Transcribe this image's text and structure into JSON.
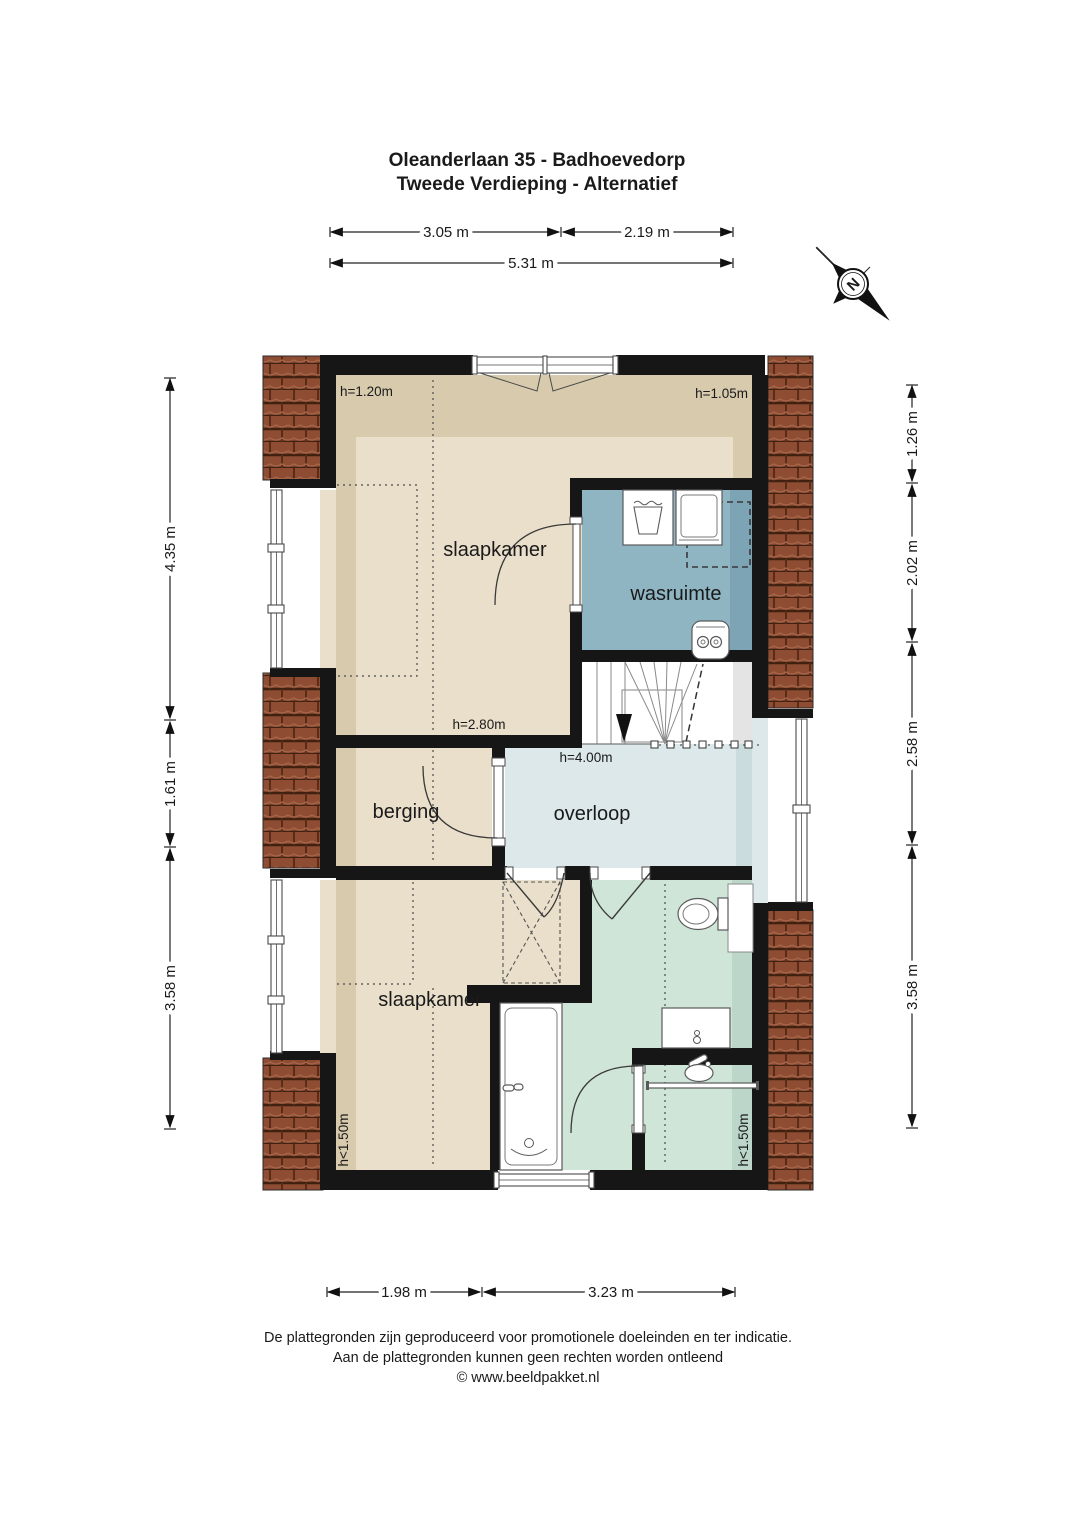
{
  "title": {
    "line1": "Oleanderlaan 35 - Badhoevedorp",
    "line2": "Tweede Verdieping - Alternatief"
  },
  "compass": {
    "label": "N"
  },
  "rooms": {
    "bedroom_top": "slaapkamer",
    "laundry": "wasruimte",
    "storage": "berging",
    "landing": "overloop",
    "bedroom_bottom": "slaapkamer"
  },
  "heights": {
    "bedroom_top_left": "h=1.20m",
    "bedroom_top_right": "h=1.05m",
    "storage": "h=2.80m",
    "landing": "h=4.00m",
    "bedroom_bottom_left": "h<1.50m",
    "bathroom_right": "h<1.50m"
  },
  "dimensions": {
    "top": [
      "3.05 m",
      "2.19 m",
      "5.31 m"
    ],
    "bottom": [
      "1.98 m",
      "3.23 m"
    ],
    "left": [
      "4.35 m",
      "1.61 m",
      "3.58 m"
    ],
    "right": [
      "1.26 m",
      "2.02 m",
      "2.58 m",
      "3.58 m"
    ]
  },
  "footer": {
    "line1": "De plattegronden zijn geproduceerd voor promotionele doeleinden en ter indicatie.",
    "line2": "Aan de plattegronden kunnen geen rechten worden ontleend",
    "line3": "© www.beeldpakket.nl"
  },
  "colors": {
    "wall": "#161616",
    "floor_beige": "#e9dfca",
    "floor_beige_shade": "#d8cbad",
    "laundry_blue": "#8fb4c2",
    "laundry_blue_shade": "#7da4b4",
    "landing_blue": "#dce8e9",
    "landing_blue_shade": "#cadcde",
    "bath_green": "#cfe5d8",
    "bath_green_shade": "#bcd7c9",
    "roof_brown": "#8e4c33",
    "stair_gray": "#e4e4e4"
  }
}
